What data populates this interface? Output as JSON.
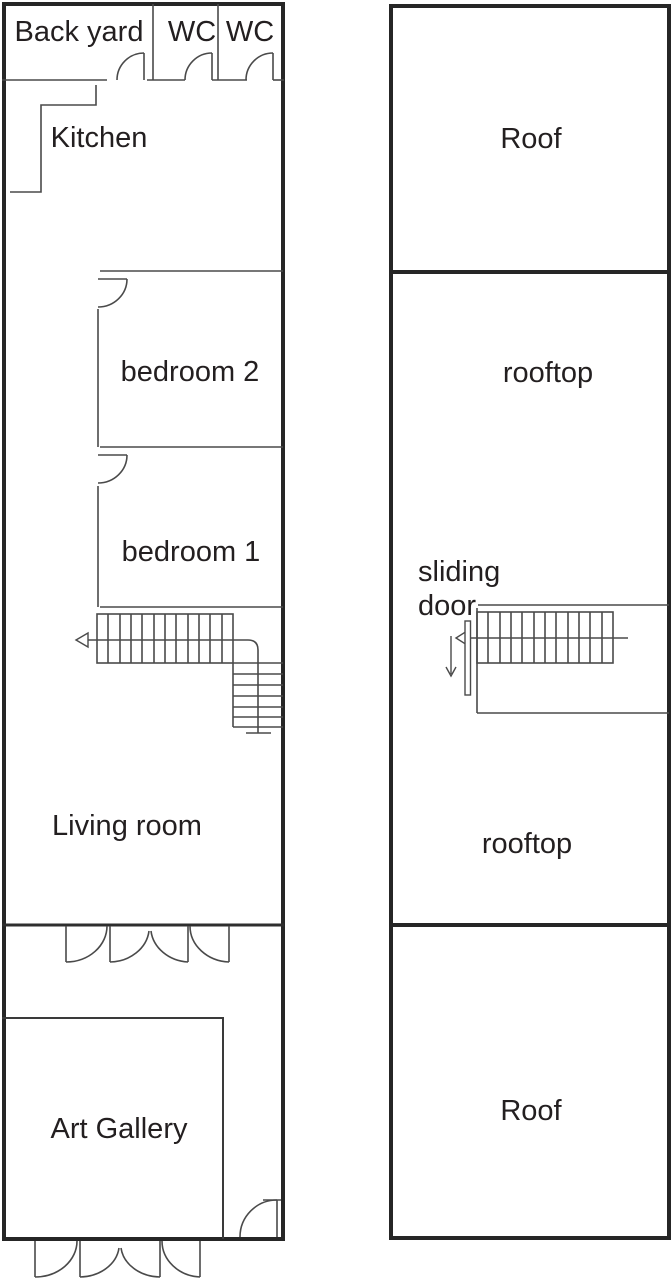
{
  "colors": {
    "line": "#4a4a4a",
    "wall": "#262626",
    "text": "#231f20",
    "background": "#ffffff"
  },
  "ground_floor": {
    "back_yard": "Back yard",
    "wc_left": "WC",
    "wc_right": "WC",
    "kitchen": "Kitchen",
    "bedroom_2": "bedroom 2",
    "bedroom_1": "bedroom 1",
    "living_room": "Living room",
    "art_gallery": "Art Gallery"
  },
  "roof_floor": {
    "roof_front": "Roof",
    "rooftop_upper": "rooftop",
    "sliding_door_line1": "sliding",
    "sliding_door_line2": "door",
    "rooftop_lower": "rooftop",
    "roof_back": "Roof"
  }
}
